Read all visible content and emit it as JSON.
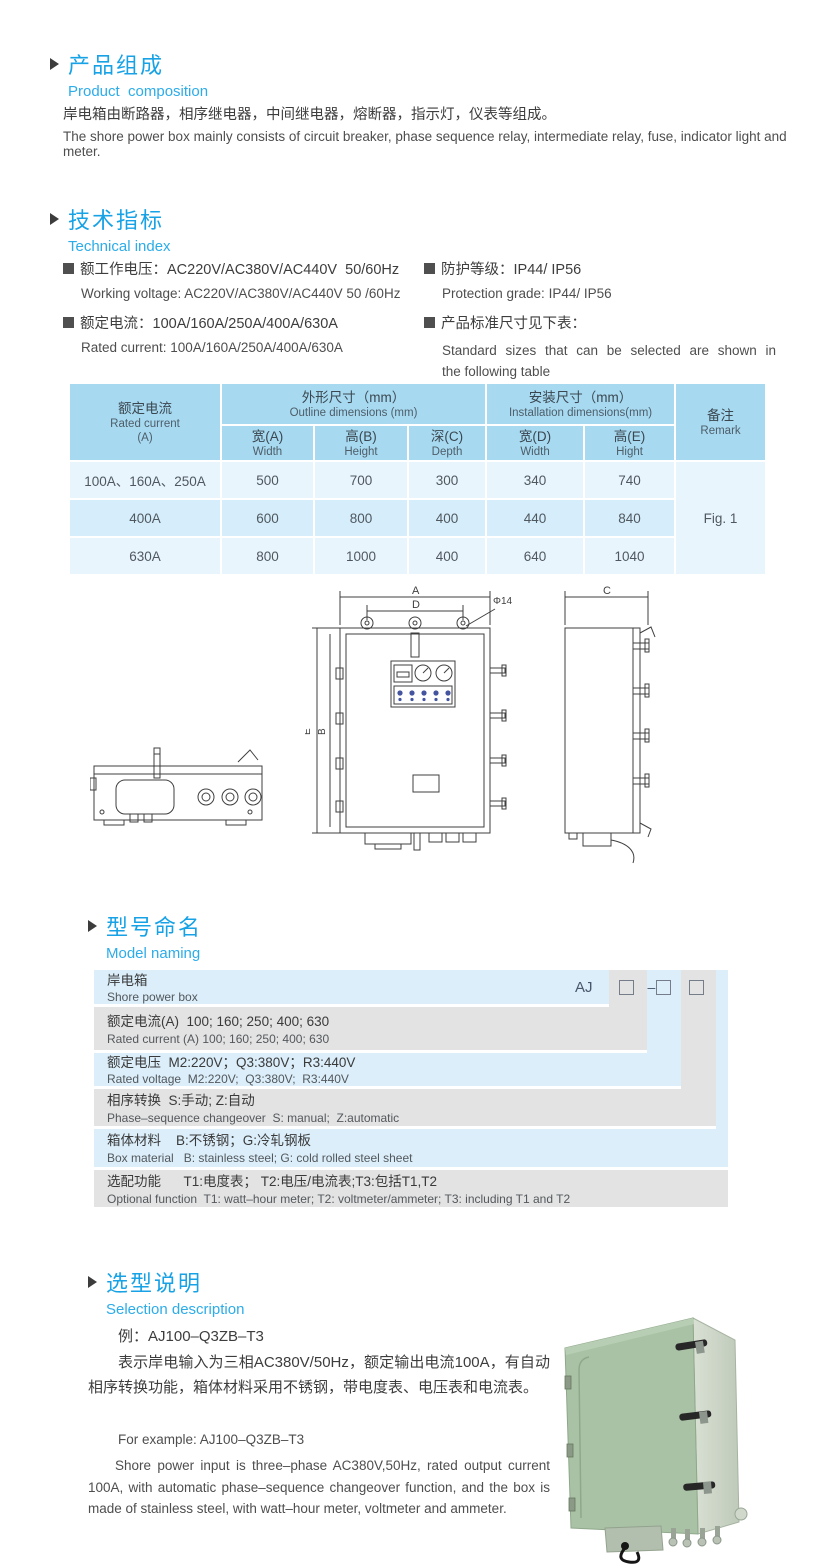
{
  "composition": {
    "title_zh": "产品组成",
    "title_en": "Product  composition",
    "body_zh": "岸电箱由断路器，相序继电器，中间继电器，熔断器，指示灯，仪表等组成。",
    "body_en": "The shore power box mainly consists of circuit breaker, phase sequence relay, intermediate relay, fuse, indicator light and meter."
  },
  "technical": {
    "title_zh": "技术指标",
    "title_en": "Technical index",
    "items": [
      {
        "zh": "额工作电压：AC220V/AC380V/AC440V  50/60Hz",
        "en": "Working voltage: AC220V/AC380V/AC440V 50 /60Hz"
      },
      {
        "zh": "额定电流：100A/160A/250A/400A/630A",
        "en": "Rated current: 100A/160A/250A/400A/630A"
      },
      {
        "zh": "防护等级：IP44/ IP56",
        "en": "Protection grade: IP44/ IP56"
      },
      {
        "zh": "产品标准尺寸见下表：",
        "en": "Standard  sizes  that  can  be  selected  are  shown  in  the following table"
      }
    ]
  },
  "dim_table": {
    "header": {
      "col_current_zh": "额定电流",
      "col_current_en": "Rated current",
      "col_current_unit": "(A)",
      "group_outline_zh": "外形尺寸（mm）",
      "group_outline_en": "Outline dimensions (mm)",
      "group_install_zh": "安装尺寸（mm）",
      "group_install_en": "Installation dimensions(mm)",
      "sub": [
        {
          "zh": "宽(A)",
          "en": "Width"
        },
        {
          "zh": "高(B)",
          "en": "Height"
        },
        {
          "zh": "深(C)",
          "en": "Depth"
        },
        {
          "zh": "宽(D)",
          "en": "Width"
        },
        {
          "zh": "高(E)",
          "en": "Hight"
        }
      ],
      "col_remark_zh": "备注",
      "col_remark_en": "Remark"
    },
    "rows": [
      [
        "100A、160A、250A",
        "500",
        "700",
        "300",
        "340",
        "740"
      ],
      [
        "400A",
        "600",
        "800",
        "400",
        "440",
        "840"
      ],
      [
        "630A",
        "800",
        "1000",
        "400",
        "640",
        "1040"
      ]
    ],
    "remark_value": "Fig. 1"
  },
  "drawing": {
    "dim_a": "A",
    "dim_b": "B",
    "dim_c": "C",
    "dim_d": "D",
    "dim_e": "E",
    "hole": "Φ14"
  },
  "model_naming": {
    "title_zh": "型号命名",
    "title_en": "Model naming",
    "code_prefix": "AJ",
    "code_dash": "–",
    "rows": [
      {
        "zh": "岸电箱",
        "en": "Shore power box"
      },
      {
        "zh": "额定电流(A)  100; 160; 250; 400; 630",
        "en": "Rated current (A) 100; 160; 250; 400; 630"
      },
      {
        "zh": "额定电压  M2:220V；Q3:380V；R3:440V",
        "en": "Rated voltage  M2:220V;  Q3:380V;  R3:440V"
      },
      {
        "zh": "相序转换  S:手动; Z:自动",
        "en": "Phase–sequence changeover  S: manual;  Z:automatic"
      },
      {
        "zh": "箱体材料    B:不锈钢；G:冷轧钢板",
        "en": "Box material   B: stainless steel; G: cold rolled steel sheet"
      },
      {
        "zh": "选配功能      T1:电度表； T2:电压/电流表;T3:包括T1,T2",
        "en": "Optional function  T1: watt–hour meter; T2: voltmeter/ammeter; T3: including T1 and T2"
      }
    ]
  },
  "selection": {
    "title_zh": "选型说明",
    "title_en": "Selection description",
    "example_zh": "例：AJ100–Q3ZB–T3",
    "body_zh": "表示岸电输入为三相AC380V/50Hz，额定输出电流100A，有自动相序转换功能，箱体材料采用不锈钢，带电度表、电压表和电流表。",
    "example_en": "For example: AJ100–Q3ZB–T3",
    "body_en": "Shore  power  input  is  three–phase  AC380V,50Hz,  rated  output current 100A, with automatic phase–sequence changeover function, and the  box  is  made  of  stainless  steel,  with  watt–hour  meter,  voltmeter  and ammeter."
  }
}
